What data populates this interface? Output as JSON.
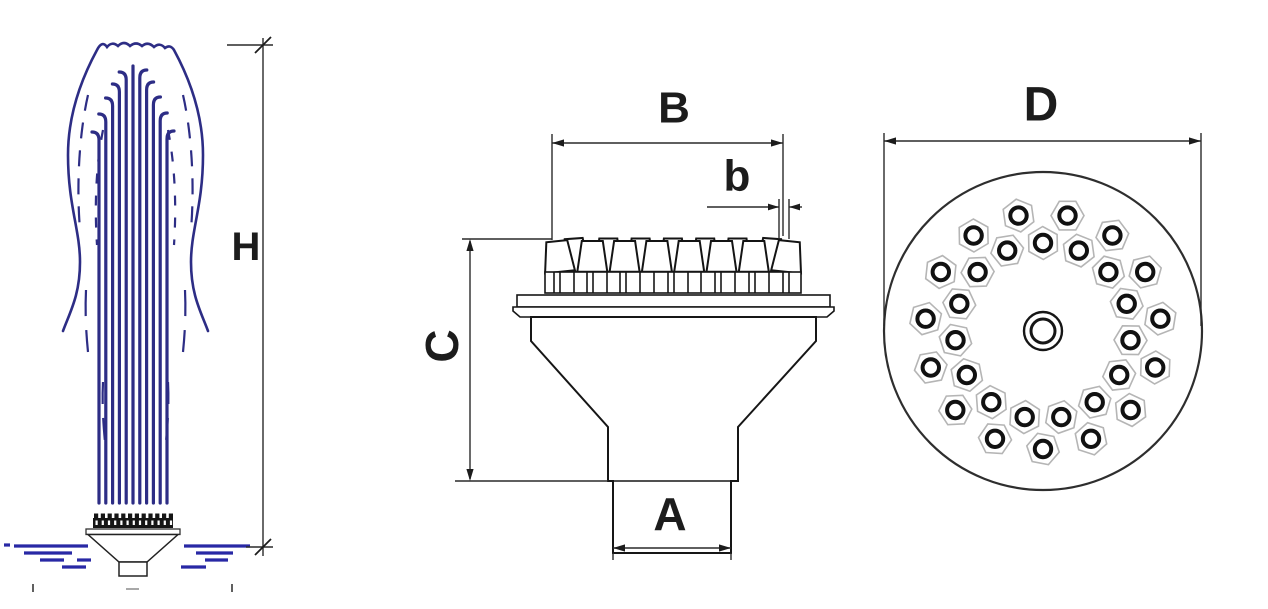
{
  "labels": {
    "height": "H",
    "head_width": "B",
    "jet_width": "b",
    "body_height": "C",
    "inlet_width": "A",
    "plate_diameter": "D"
  },
  "colors": {
    "line": "#1c1c1c",
    "spray_blue": "#2d2d85",
    "water_blue": "#2828a5",
    "hex_outline": "#b5b5b5"
  },
  "drawing": {
    "jets": {
      "x_start": 99,
      "x_step": 6.8,
      "count": 11,
      "bottom": 503,
      "tops": [
        132,
        114,
        98,
        84,
        72,
        66,
        70,
        82,
        97,
        113,
        131
      ],
      "hook": 7
    },
    "water_dashes": [
      [
        4,
        545,
        10
      ],
      [
        14,
        546,
        88
      ],
      [
        24,
        553,
        72
      ],
      [
        40,
        560,
        64
      ],
      [
        77,
        560,
        91
      ],
      [
        62,
        567,
        86
      ],
      [
        184,
        546,
        250
      ],
      [
        196,
        553,
        233
      ],
      [
        205,
        560,
        228
      ],
      [
        181,
        567,
        206
      ]
    ],
    "device": {
      "band": {
        "x": 93,
        "y": 518,
        "w": 80,
        "h": 10
      },
      "dots": {
        "count": 13,
        "x0": 95.5,
        "step": 6.2,
        "y": 520.5,
        "w": 2.2,
        "h": 4.5
      },
      "bumps": {
        "count": 12,
        "x0": 94,
        "step": 6.8,
        "y": 513.5,
        "w": 4.2,
        "h": 5
      }
    },
    "band": {
      "x": 545,
      "y": 272,
      "w": 256,
      "h": 21,
      "dividers": [
        9,
        15,
        29,
        42,
        48,
        62,
        75,
        81,
        95,
        109,
        123,
        129,
        143,
        156,
        170,
        176,
        190,
        204,
        210,
        224,
        238,
        244
      ]
    },
    "nozzle_row": {
      "front": {
        "count": 8,
        "cx0": 560,
        "step": 32.3,
        "bw": 30,
        "tw": 21,
        "y_top": 241,
        "y_bot": 271.8,
        "tilt": 6
      },
      "back": {
        "count": 7,
        "cx0": 576,
        "step": 32.3,
        "bw": 27,
        "tw": 18,
        "y_top": 238.5,
        "y_bot": 271.8,
        "tilt": 4
      }
    },
    "plan": {
      "cx": 1043,
      "cy": 331,
      "R": 159,
      "rings": [
        {
          "count": 15,
          "start": 12,
          "step": 24,
          "r": 118
        },
        {
          "count": 15,
          "start": 0,
          "step": 24,
          "r": 88
        }
      ],
      "hole_r": 8.2,
      "hole_stroke": 4,
      "hex_r": 16.5,
      "center": {
        "r_outer": 19,
        "r_inner": 12
      }
    }
  }
}
